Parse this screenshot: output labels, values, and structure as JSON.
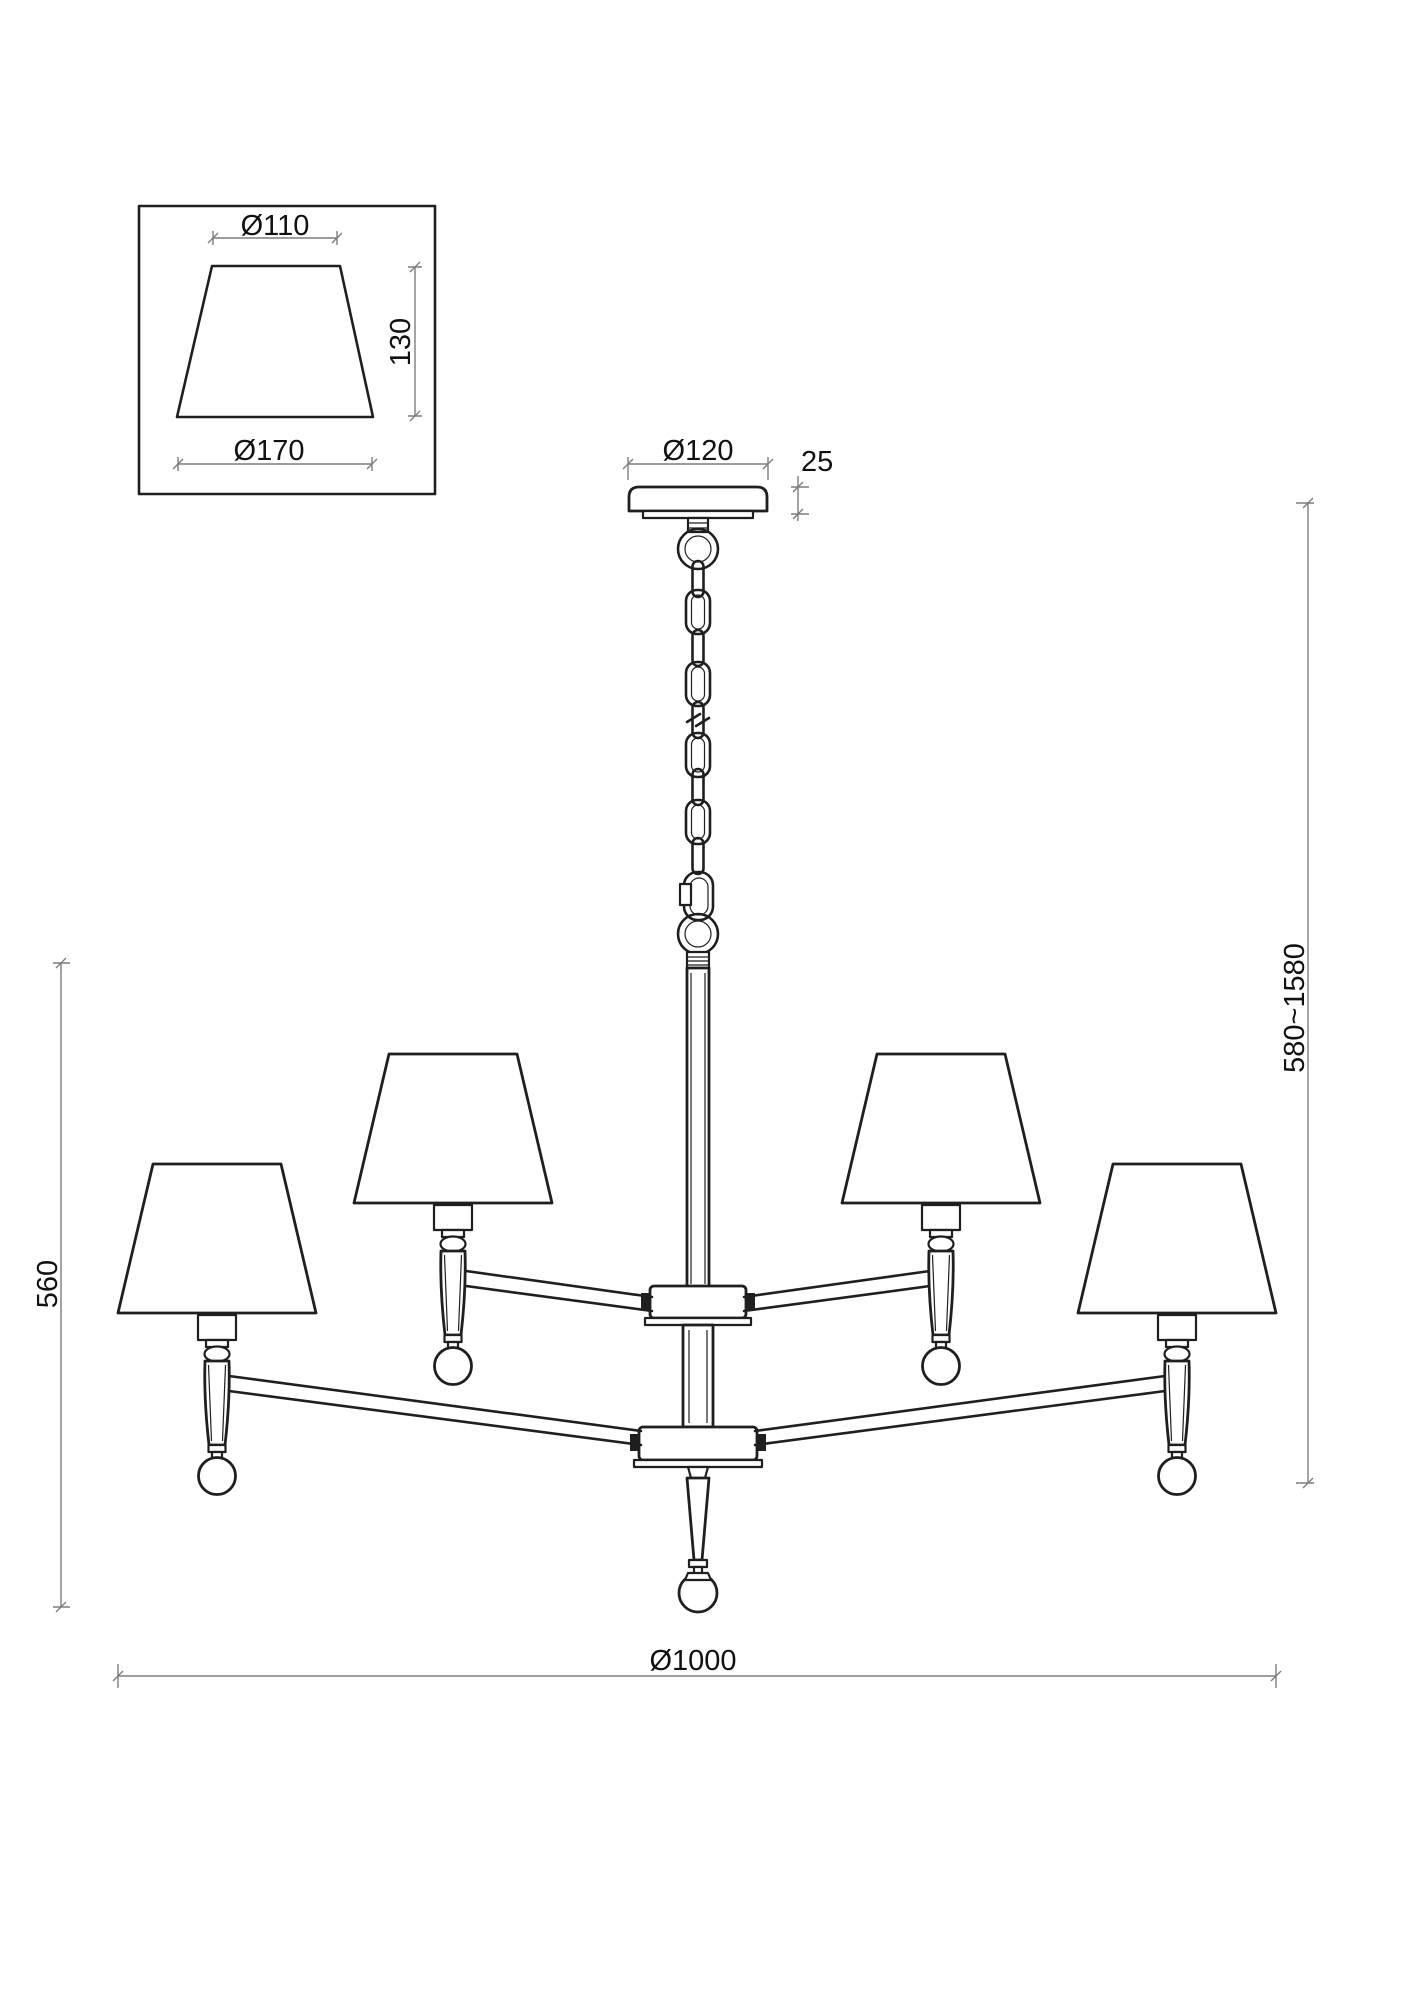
{
  "page": {
    "background": "#ffffff"
  },
  "colors": {
    "outline": "#1f1f1f",
    "dimension_line": "#7d7d7d",
    "text": "#111111"
  },
  "drawing": {
    "type": "technical-dimension-drawing",
    "subject": "4-arm two-tier chandelier with tapered fabric shades on adjustable chain suspension",
    "shade_detail": {
      "top_diameter_label": "Ø110",
      "height_label": "130",
      "bottom_diameter_label": "Ø170"
    },
    "canopy": {
      "diameter_label": "Ø120",
      "thickness_label": "25"
    },
    "overall": {
      "suspension_height_label": "580~1580",
      "body_height_label": "560",
      "body_diameter_label": "Ø1000"
    }
  }
}
